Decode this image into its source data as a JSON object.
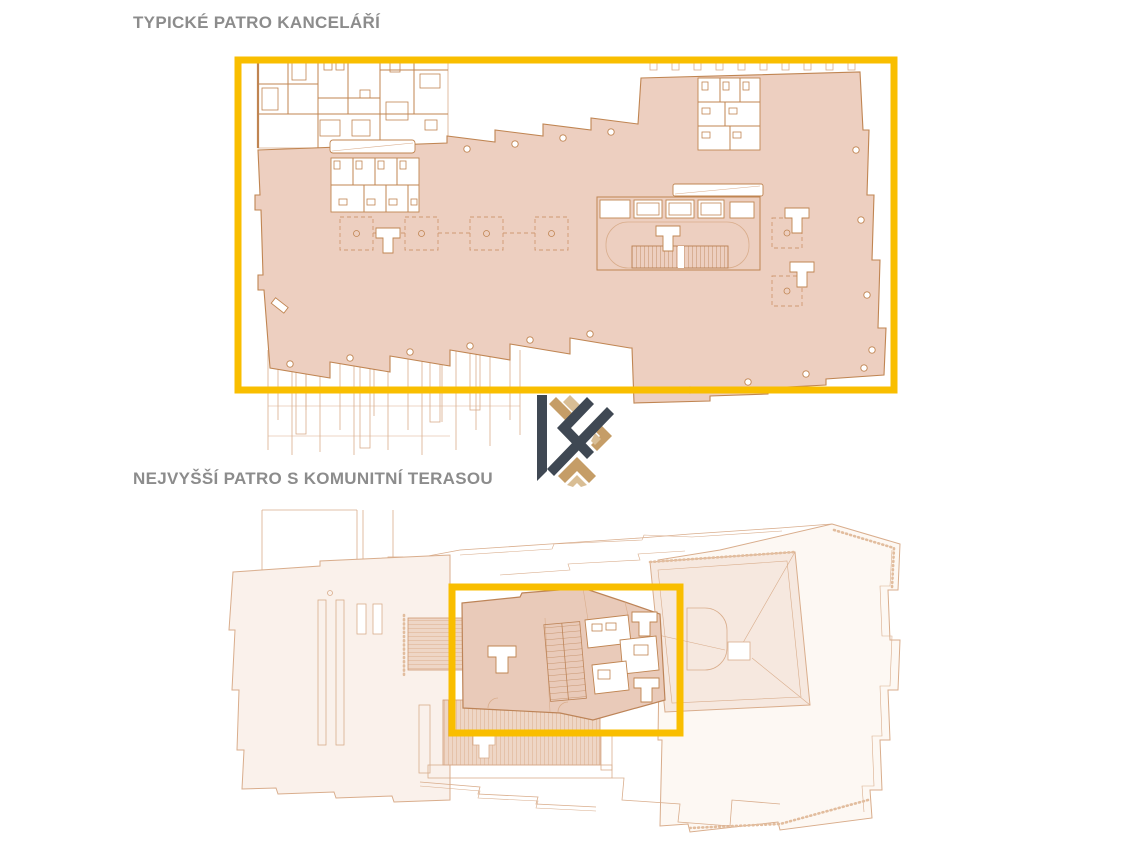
{
  "page": {
    "background": "#FFFFFF"
  },
  "sections": [
    {
      "id": "typical-office-floor",
      "title": "TYPICKÉ PATRO KANCELÁŘÍ"
    },
    {
      "id": "top-floor-community-terrace",
      "title": "NEJVYŠŠÍ PATRO S KOMUNITNÍ TERASOU"
    }
  ],
  "colors": {
    "highlight_gold": "#F9BE00",
    "plan_fill_salmon": "#EDCFC0",
    "plan_fill_salmon_dark": "#E9CAB9",
    "plan_fill_light": "#FAF1EB",
    "plan_fill_pink": "#F6E8DF",
    "plan_line": "#C08552",
    "plan_line_faint": "#D9AD8C",
    "heading_gray": "#8C8C8C",
    "logo_navy": "#3F4853",
    "logo_tan": "#C59D67"
  },
  "logo": {
    "name": "K monogram logo"
  }
}
